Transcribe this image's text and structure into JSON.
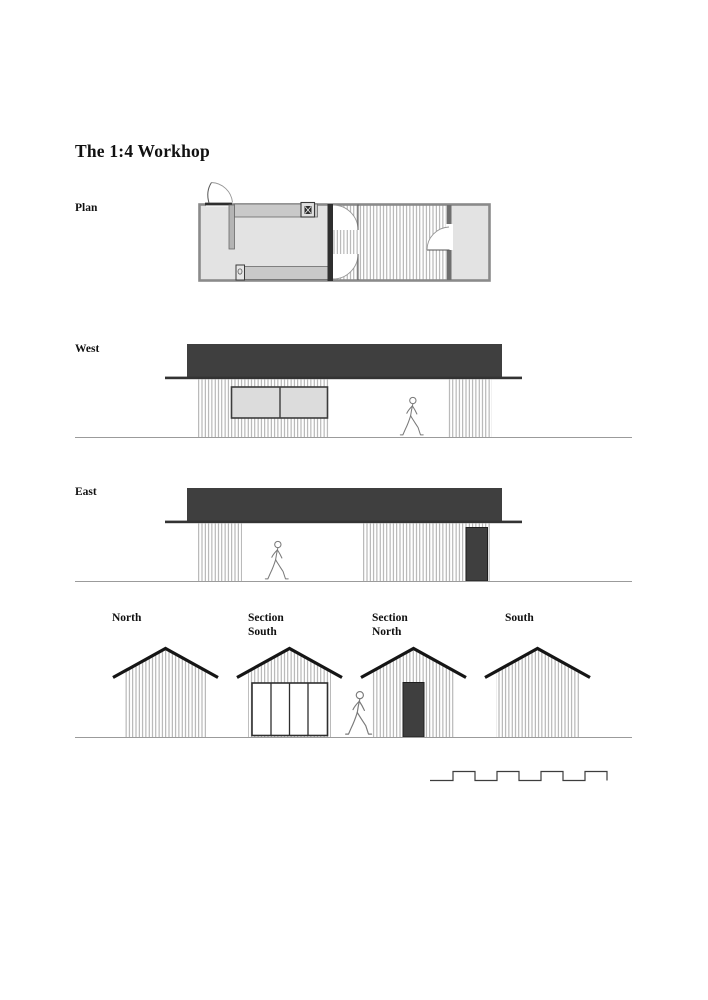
{
  "title": "The 1:4 Workhop",
  "views": {
    "plan": {
      "label": "Plan"
    },
    "west": {
      "label": "West"
    },
    "east": {
      "label": "East"
    },
    "north": {
      "label": "North"
    },
    "section_south": {
      "label": "Section South"
    },
    "section_north": {
      "label": "Section North"
    },
    "south": {
      "label": "South"
    }
  },
  "colors": {
    "roof": "#3f3f3f",
    "dark_door": "#3f3f3f",
    "cladding_line": "#9a9a9a",
    "room_fill": "#e3e3e3",
    "bench_fill": "#c9c9c9",
    "wall_line": "#8a8a8a",
    "ground_line": "#9b9b9b",
    "ink": "#111111",
    "paper": "#ffffff"
  }
}
